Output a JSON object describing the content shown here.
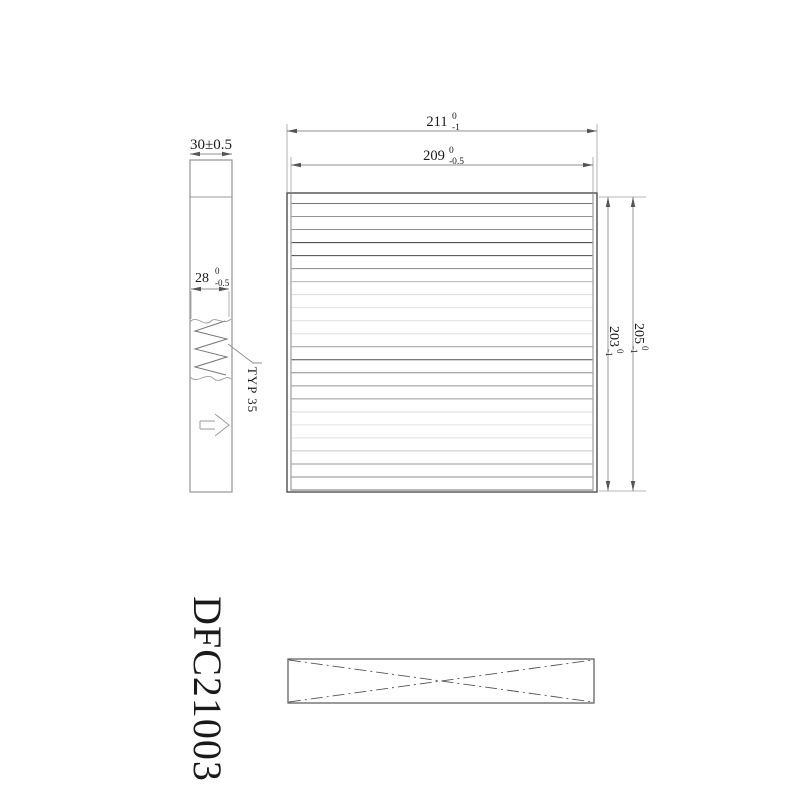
{
  "drawing": {
    "part_number": "DFC21003",
    "ink": {
      "line": "#4d4d4d",
      "frame": "#8a8a8a",
      "dim": "#8f8f8f",
      "text": "#1a1a1a"
    },
    "side_view": {
      "depth": {
        "text": "30±0.5"
      },
      "media_depth": {
        "value": "28",
        "sup": "0",
        "sub": "-0.5"
      },
      "pleat_note": "TYP 35"
    },
    "front_view": {
      "outer_width": {
        "value": "211",
        "sup": "0",
        "sub": "-1"
      },
      "inner_width": {
        "value": "209",
        "sup": "0",
        "sub": "-0.5"
      },
      "outer_height": {
        "value": "205",
        "sup": "0",
        "sub": "-1"
      },
      "inner_height": {
        "value": "203",
        "sup": "0",
        "sub": "-1"
      },
      "pleats": {
        "count": 23,
        "shades": [
          "#777777",
          "#949494",
          "#8f8f8f",
          "#3d3d3d",
          "#484848",
          "#8a8a8a",
          "#b5b5b5",
          "#dcdcdc",
          "#e3e3e3",
          "#e0e0e0",
          "#dedede",
          "#9f9f9f",
          "#4f4f4f",
          "#8c8c8c",
          "#939393",
          "#9a9a9a",
          "#dadada",
          "#e2e2e2",
          "#dddddd",
          "#c7c7c7",
          "#979797",
          "#8e8e8e",
          "#6f6f6f"
        ]
      }
    }
  }
}
